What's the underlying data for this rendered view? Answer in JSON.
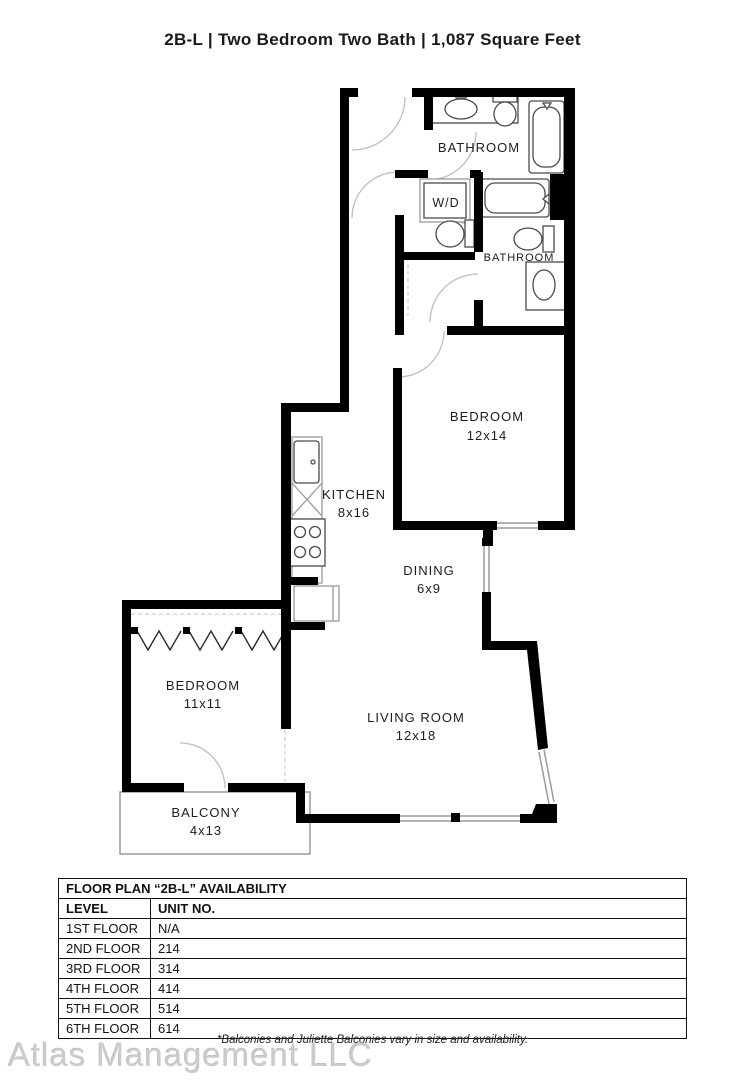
{
  "page": {
    "title": "2B-L | Two Bedroom Two Bath | 1,087  Square Feet"
  },
  "floorplan": {
    "rooms": {
      "bathroom_main": {
        "name": "BATHROOM"
      },
      "laundry": {
        "name": "W/D"
      },
      "bathroom_second": {
        "name": "BATHROOM"
      },
      "bedroom_main": {
        "name": "BEDROOM",
        "dims": "12x14"
      },
      "kitchen": {
        "name": "KITCHEN",
        "dims": "8x16"
      },
      "dining": {
        "name": "DINING",
        "dims": "6x9"
      },
      "bedroom_second": {
        "name": "BEDROOM",
        "dims": "11x11"
      },
      "living_room": {
        "name": "LIVING ROOM",
        "dims": "12x18"
      },
      "balcony": {
        "name": "BALCONY",
        "dims": "4x13"
      }
    }
  },
  "availability": {
    "title": "FLOOR PLAN “2B-L” AVAILABILITY",
    "columns": {
      "level": "LEVEL",
      "unit": "UNIT NO."
    },
    "rows": [
      {
        "level": "1ST FLOOR",
        "unit": "N/A"
      },
      {
        "level": "2ND FLOOR",
        "unit": "214"
      },
      {
        "level": "3RD FLOOR",
        "unit": "314"
      },
      {
        "level": "4TH FLOOR",
        "unit": "414"
      },
      {
        "level": "5TH FLOOR",
        "unit": "514"
      },
      {
        "level": "6TH FLOOR",
        "unit": "614"
      }
    ]
  },
  "footer": {
    "disclaimer": "*Balconies and Juliette Balconies vary in size and availability.",
    "watermark": "Atlas Management LLC"
  },
  "colors": {
    "wall": "#000000",
    "label": "#1d1d1d",
    "watermark": "#cbcbcb"
  }
}
